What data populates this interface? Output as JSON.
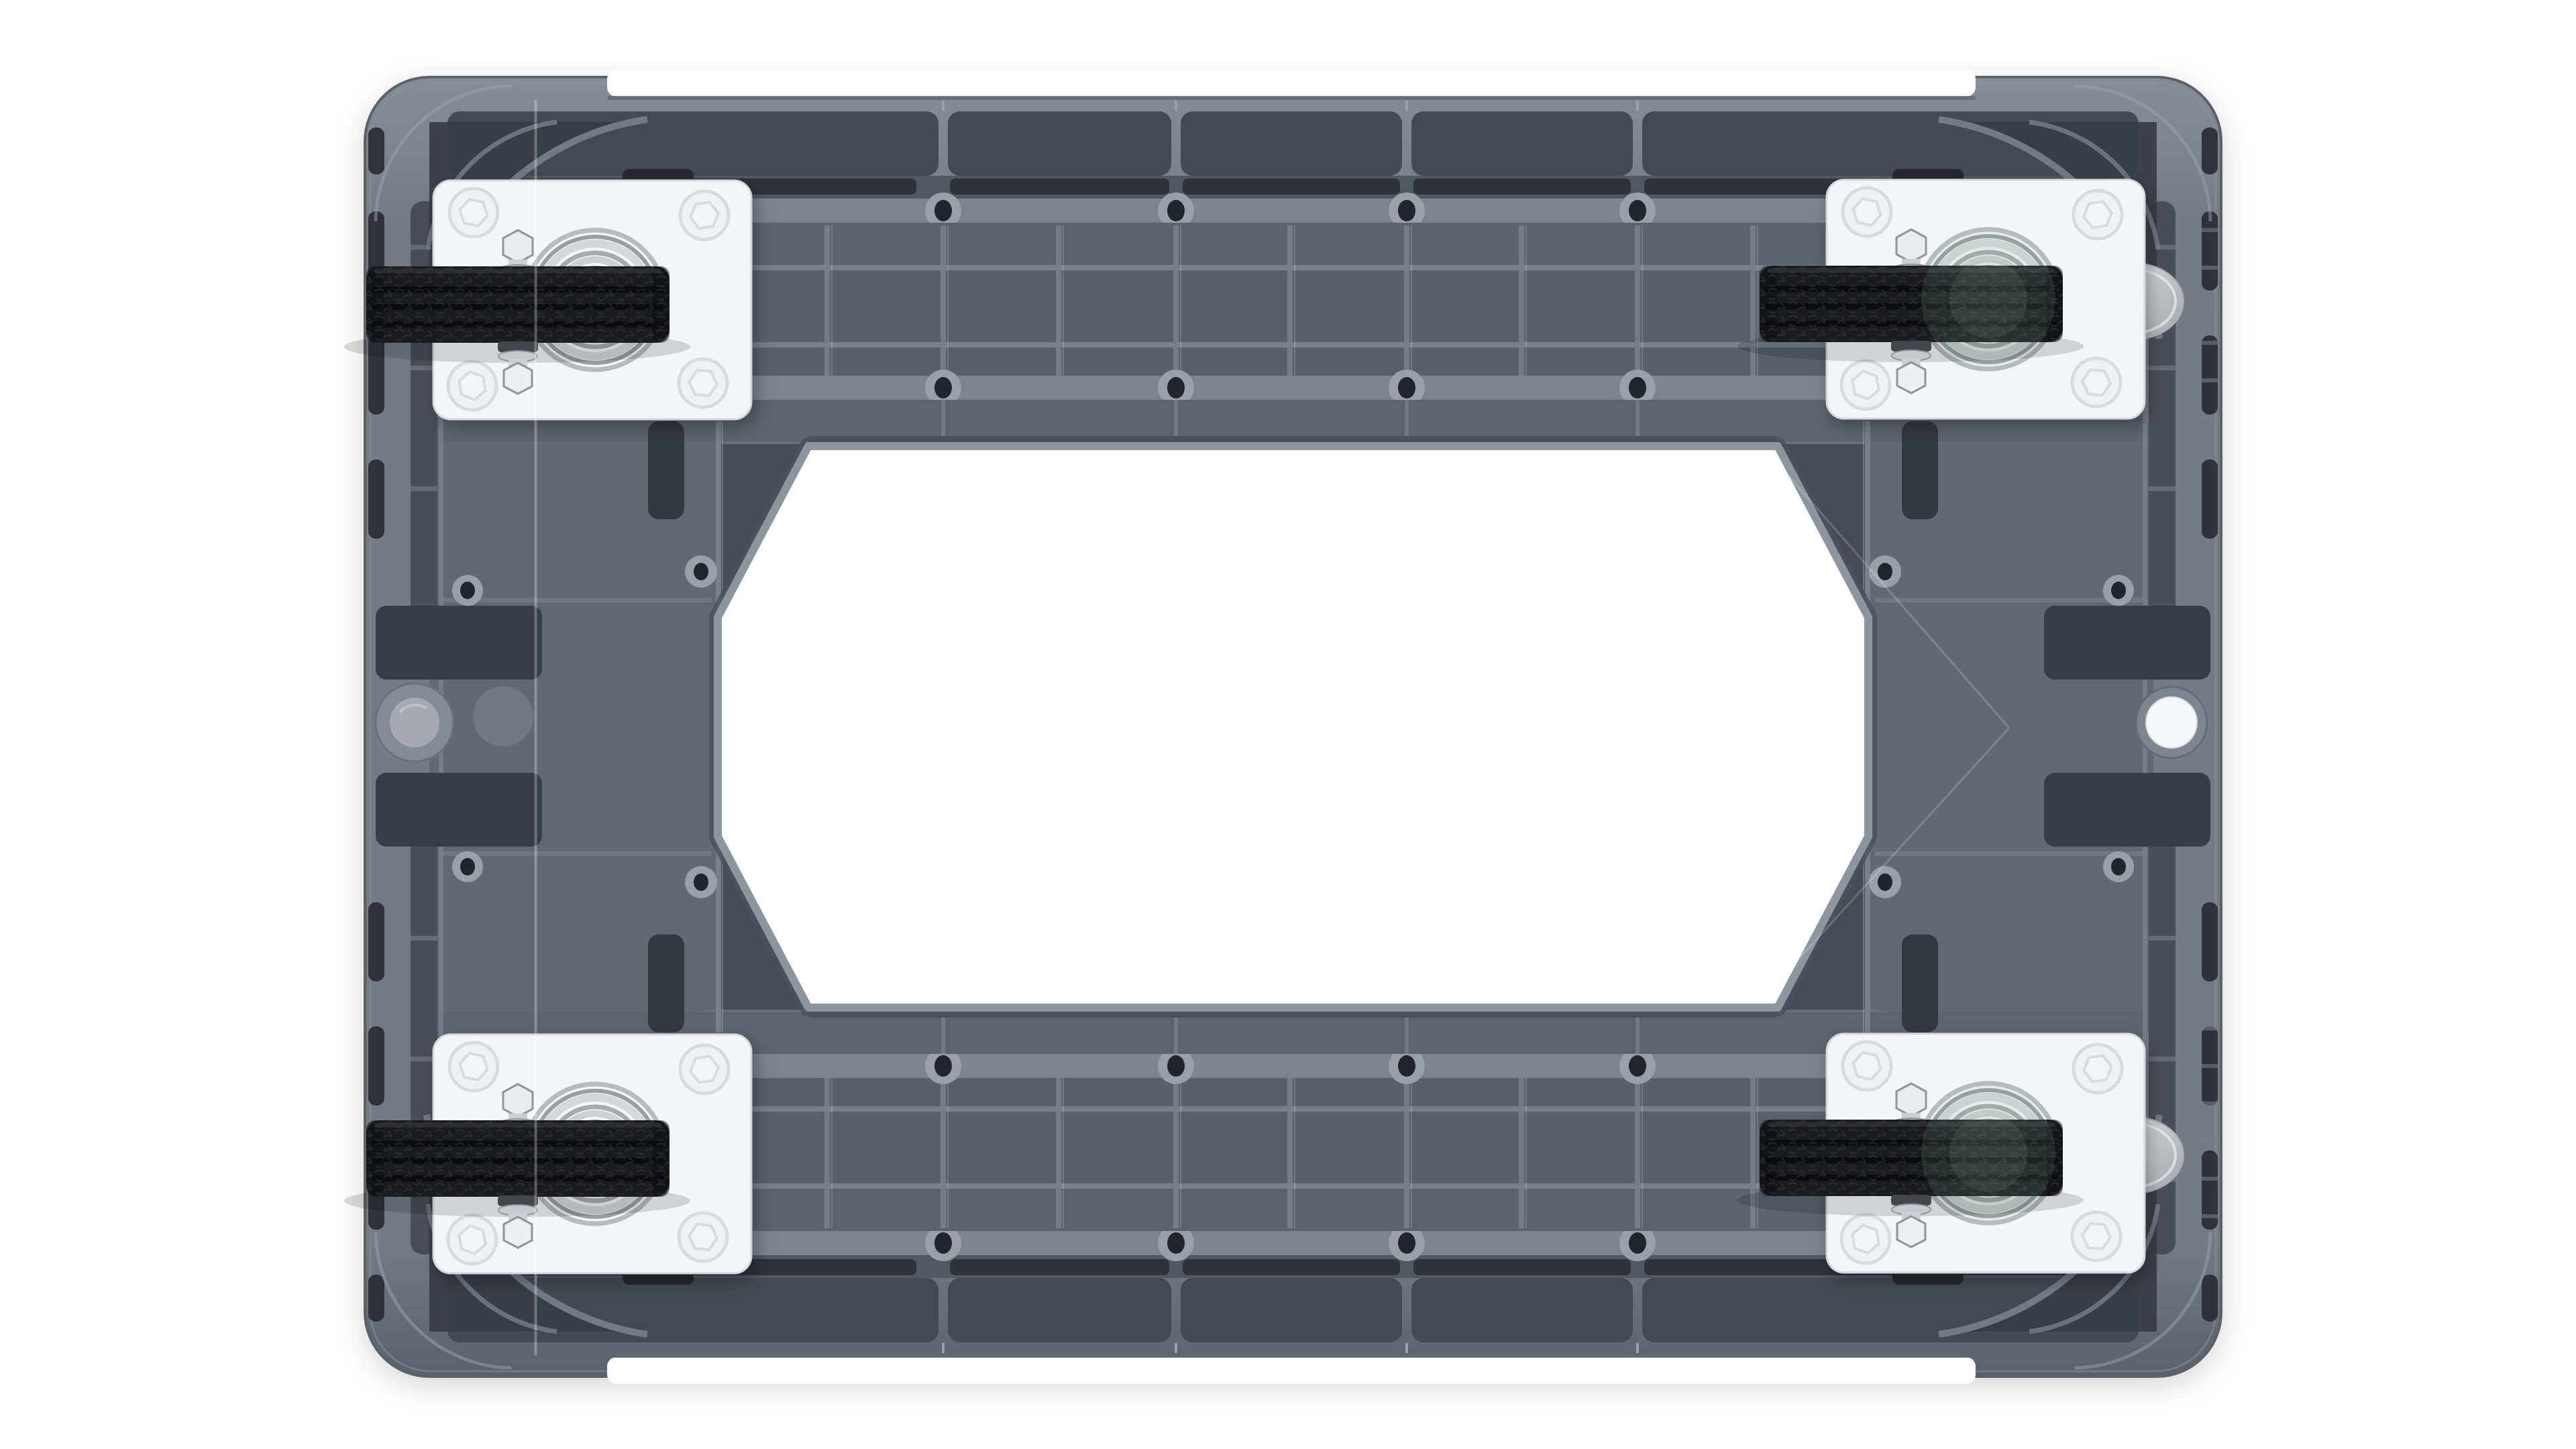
{
  "meta": {
    "domain": "Natural-Image",
    "description": "Top-down product photograph of the underside of a gray molded-plastic platform dolly on a white background. The ribbed frame has a large white octagonal cutout in the middle, rows of screw bosses, rounded bumper corners, and four swivel casters on white square mounting plates with black treaded rubber wheels. The two right-hand casters have silver brake pedals. A round gray boss sits on the left rail and a round open (white) port on the right rail."
  },
  "scene": {
    "background": "#ffffff",
    "object": "platform dolly underside",
    "view": "top-down orthographic product shot",
    "no_visible_text": true
  },
  "colors": {
    "bg": "#ffffff",
    "bodyBase": "#747a83",
    "bodyEdge": "#5b616b",
    "rimLight": "#868d96",
    "rimLighter": "#9aa0a9",
    "channel": "#4a4e57",
    "panelMid": "#5a6069",
    "panelMid2": "#525860",
    "panelDark": "#454a52",
    "panelDarker": "#383c44",
    "slotDark": "#26292f",
    "grooveDark": "#2f3239",
    "railLight": "#7d848e",
    "ribLight": "#78808a",
    "fieldMid": "#636972",
    "bossRing": "#99a0a8",
    "holeDark": "#22252b",
    "sideBossInnerLeft": "#a6aab0",
    "sideBossInnerRight": "#f5f6f8",
    "octagonFill": "#ffffff",
    "octagonRim": "#8f959e",
    "octagonStep": "#4d525b",
    "plate": "#f3f5f7",
    "plateEdge": "#d5d8dc",
    "emboss": "#eff1f3",
    "embossEdge": "#d8dbdf",
    "wheel": "#1a1b1f",
    "wheelGroove": "#0b0c0e",
    "wheelHi": "#3a3c42",
    "metal": "#ccd0d4",
    "metalDark": "#8f959b",
    "metalDarker": "#43464c",
    "bearingTint": "#8fae97",
    "pedalHi": "#dfe2e4",
    "pedalLo": "#9fa5ab",
    "seam": "#ffffff"
  },
  "parts": {
    "frame_label": "molded plastic frame",
    "cutout_label": "central octagonal cutout",
    "casters": [
      {
        "id": "caster-top-left",
        "brake": false
      },
      {
        "id": "caster-top-right",
        "brake": true
      },
      {
        "id": "caster-bottom-left",
        "brake": false
      },
      {
        "id": "caster-bottom-right",
        "brake": true
      }
    ],
    "plate_bolts_per_caster": 4,
    "wheel_tread_grooves": 3,
    "deck_screw_holes": 20,
    "side_bosses": [
      {
        "side": "left",
        "state": "closed gray plug"
      },
      {
        "side": "right",
        "state": "open through-hole"
      }
    ]
  }
}
